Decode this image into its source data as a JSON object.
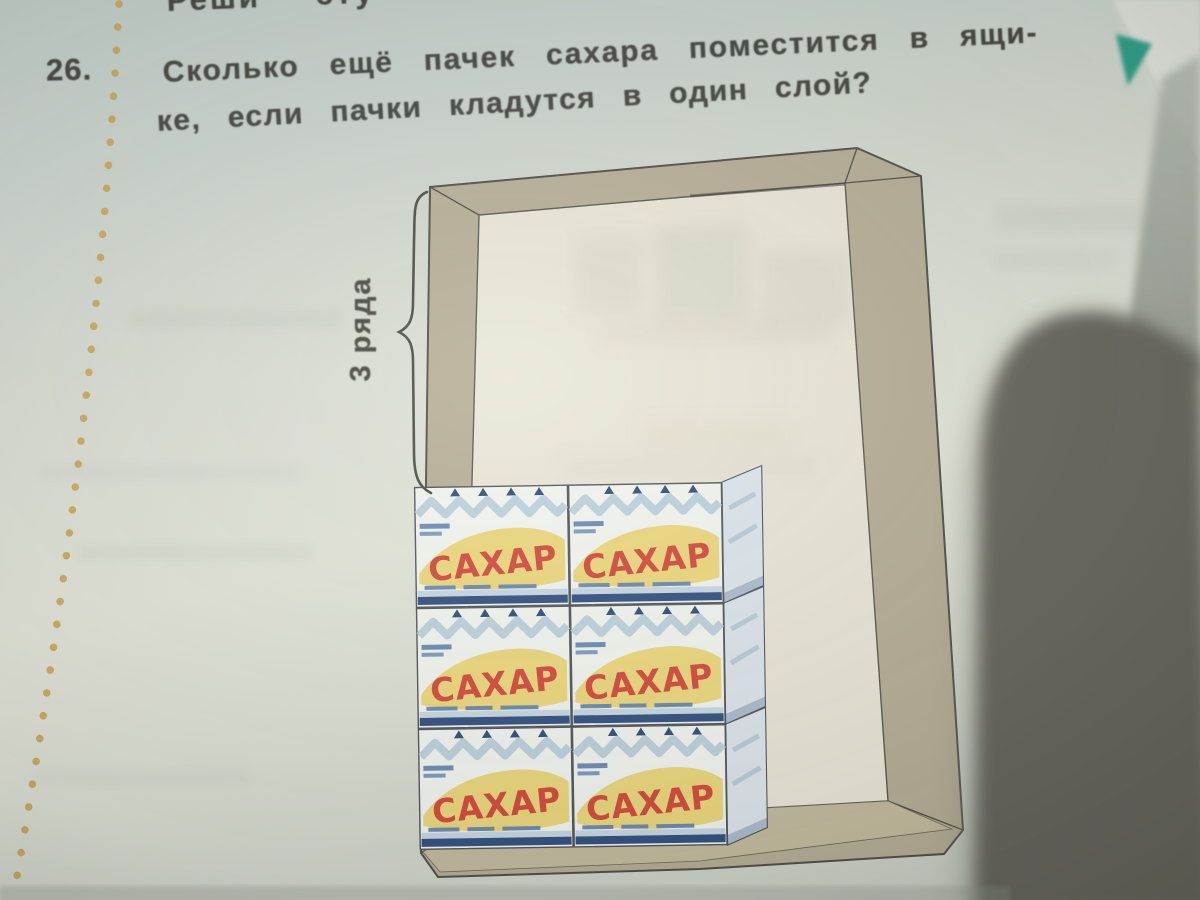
{
  "photo": {
    "top_partial_text": "Реши эту",
    "problem": {
      "number": "26.",
      "text_line1": "Сколько ещё пачек сахара поместится в ящи-",
      "text_line2": "ке, если пачки кладутся в один слой?"
    },
    "illustration": {
      "bracket_label": "3 ряда",
      "pack_brand": "САХАР",
      "pack_rows": 3,
      "pack_columns": 2,
      "visible_packs": 6
    },
    "colors": {
      "box_frame": "#b6ae96",
      "box_interior": "#eae6d8",
      "pack_face": "#f3f5f0",
      "pack_banner_yellow": "#ecd87c",
      "pack_brand_red": "#d4493b",
      "pack_stripe_navy": "#31507f",
      "dotted_line": "#c9a452",
      "corner_triangle_teal": "#2d9f88",
      "thumb_shadow": "#65655c"
    }
  }
}
